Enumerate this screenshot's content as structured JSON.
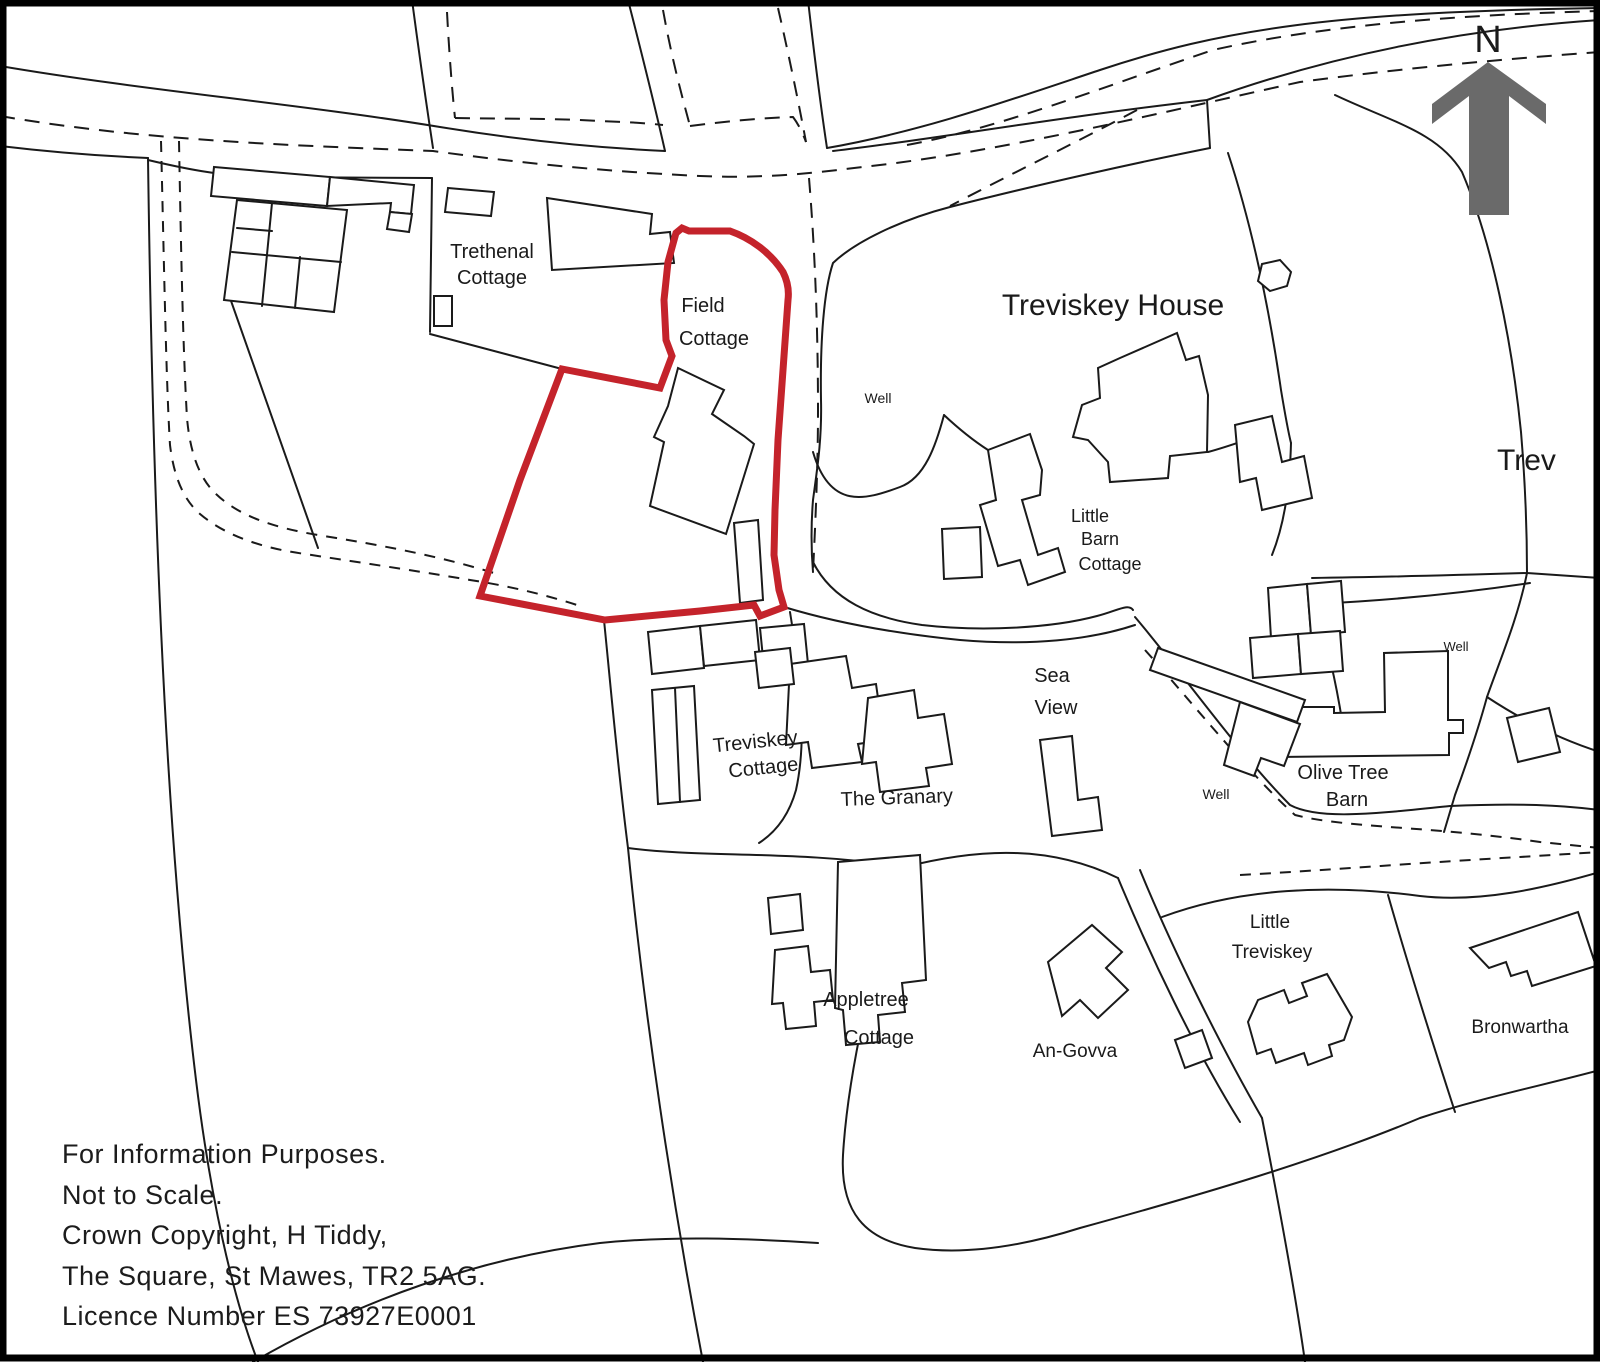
{
  "document": {
    "kind": "site location plan",
    "not_to_scale": true
  },
  "colors": {
    "boundary_red": "#c4232b",
    "ink": "#1a1a1a",
    "north_gray": "#6a6a6a",
    "paper": "#ffffff"
  },
  "north": {
    "label": "N"
  },
  "labels": {
    "trethenal_1": "Trethenal",
    "trethenal_2": "Cottage",
    "field_1": "Field",
    "field_2": "Cottage",
    "treviskey_house": "Treviskey House",
    "well_1": "Well",
    "little_barn_1": "Little",
    "little_barn_2": "Barn",
    "little_barn_3": "Cottage",
    "trev_clipped": "Trev",
    "sea_view_1": "Sea",
    "sea_view_2": "View",
    "treviskey_cottage_1": "Treviskey",
    "treviskey_cottage_2": "Cottage",
    "granary": "The Granary",
    "well_2": "Well",
    "olive_tree_1": "Olive Tree",
    "olive_tree_2": "Barn",
    "well_3": "Well",
    "little_treviskey_1": "Little",
    "little_treviskey_2": "Treviskey",
    "bronwartha": "Bronwartha",
    "an_govva": "An-Govva",
    "appletree_1": "Appletree",
    "appletree_2": "Cottage"
  },
  "notes": [
    "For Information Purposes.",
    "Not to Scale.",
    "Crown Copyright, H Tiddy,",
    "The Square, St Mawes, TR2 5AG.",
    "Licence Number ES 73927E0001"
  ]
}
